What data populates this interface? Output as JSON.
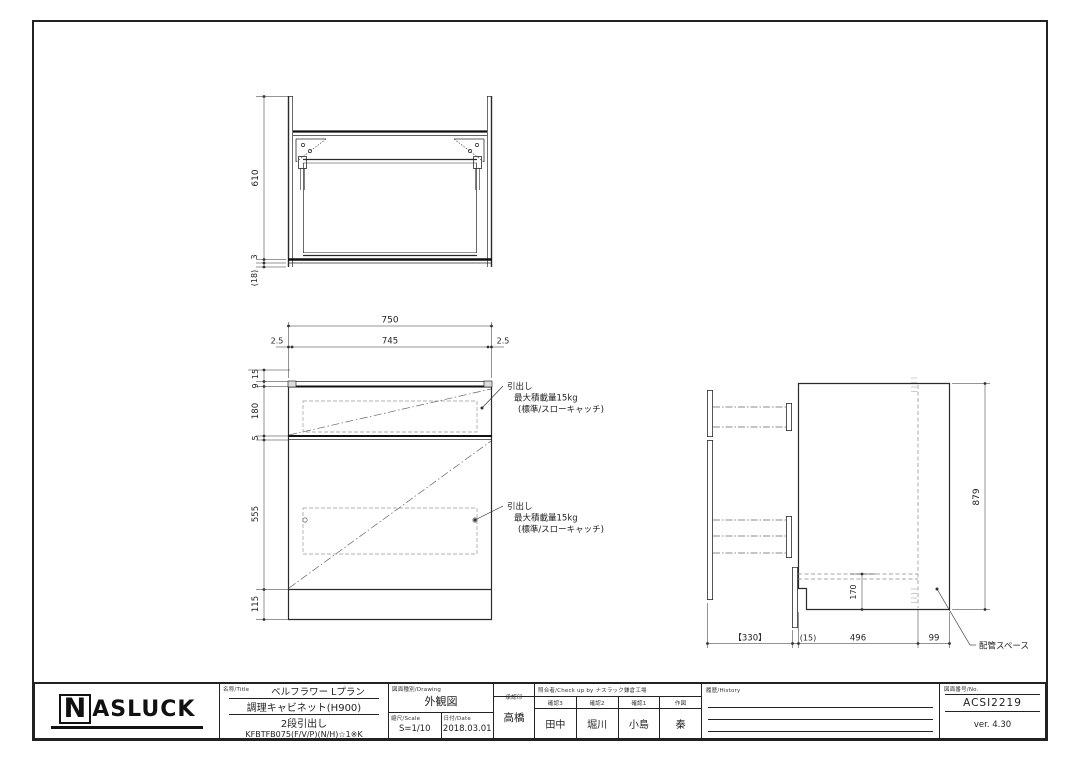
{
  "title_block": {
    "logo_n": "N",
    "logo_rest": "ASLUCK",
    "name_label": "名称/Title",
    "product_series": "ベルフラワー Lプラン",
    "product_name": "調理キャビネット(H900)",
    "product_type": "2段引出し",
    "product_code": "KFBTFB075(F/V/P)(N/H)☆1※K",
    "drawing_label": "図面種別/Drawing",
    "drawing_type": "外観図",
    "scale_label": "縮尺/Scale",
    "scale_value": "S=1/10",
    "date_label": "日付/Date",
    "date_value": "2018.03.01",
    "approval_label": "承認印",
    "approval_name": "高橋",
    "check_label": "照合者/Check up by ナスラック鎌倉工場",
    "check_cols": [
      {
        "label": "確認3",
        "name": "田中"
      },
      {
        "label": "確認2",
        "name": "堀川"
      },
      {
        "label": "確認1",
        "name": "小島"
      },
      {
        "label": "作図",
        "name": "秦"
      }
    ],
    "history_label": "履歴/History",
    "no_label": "図面番号/No.",
    "drawing_no": "ACSI2219",
    "version": "ver. 4.30"
  },
  "top_view": {
    "dim_depth": "610",
    "dim_3": "3",
    "dim_18": "(18)"
  },
  "front_view": {
    "dim_w": "750",
    "dim_edge_l": "2.5",
    "dim_inner": "745",
    "dim_edge_r": "2.5",
    "dim_15": "15",
    "dim_9": "9",
    "dim_180": "180",
    "dim_5": "5",
    "dim_555": "555",
    "dim_115": "115",
    "note_line1": "引出し",
    "note_line2": "最大積載量15kg",
    "note_line3": "(標準/スローキャッチ)"
  },
  "side_view": {
    "dim_h": "879",
    "dim_170": "170",
    "dim_330": "【330】",
    "dim_15": "(15)",
    "dim_496": "496",
    "dim_99": "99",
    "pipe_note": "配管スペース"
  }
}
